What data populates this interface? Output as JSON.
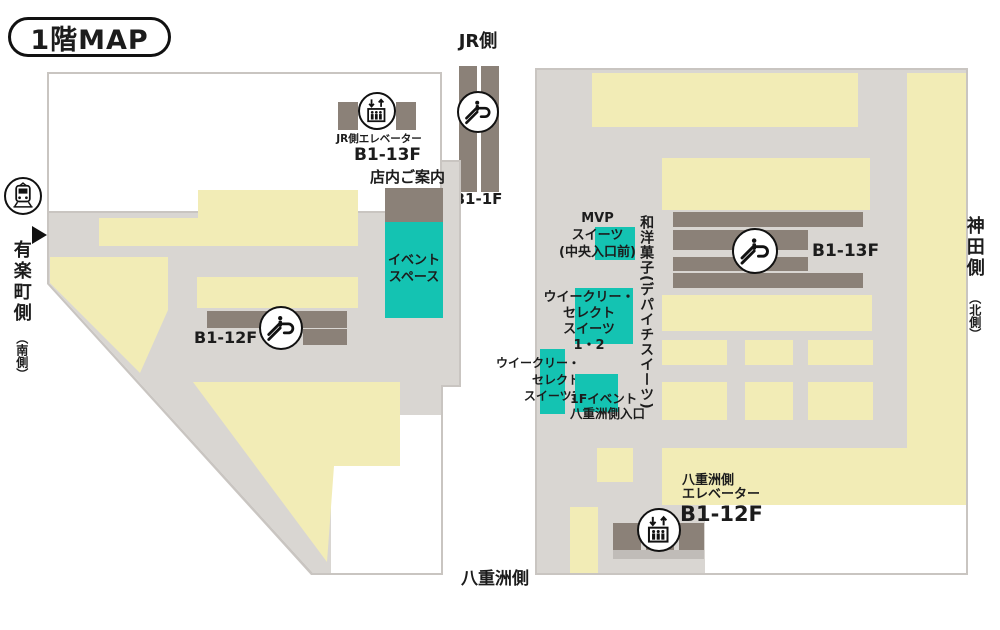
{
  "title": "1階MAP",
  "colors": {
    "floor": "#d9d6d2",
    "floor_border": "#c9c5c1",
    "sales": "#f2ecb6",
    "fixture": "#8b8178",
    "teal": "#14c3b2",
    "ink": "#1c1c1c"
  },
  "labels": {
    "jr_side": "JR側",
    "jr_escalator_floors": "B1-1F",
    "yurakucho": "有楽町側",
    "yurakucho_sub": "（南側）",
    "kanda": "神田側",
    "kanda_sub": "（北側）",
    "yaesu_bottom": "八重洲側"
  },
  "left_building": {
    "jr_elevator_label": "JR側エレベーター",
    "jr_elevator_floors": "B1-13F",
    "info_label": "店内ご案内",
    "event_space": [
      "イベント",
      "スペース"
    ],
    "escalator_floors": "B1-12F"
  },
  "right_building": {
    "escalator_floors": "B1-13F",
    "mvp_sweets": [
      "MVP",
      "スイーツ",
      "(中央入口前)"
    ],
    "wagashi_vertical": "和洋菓子(デパイチスイーツ)",
    "weekly_select_12": [
      "ウイークリー・",
      "セレクト",
      "スイーツ",
      "1・2"
    ],
    "weekly_select_3": [
      "ウイークリー・",
      "セレクト",
      "スイーツ3"
    ],
    "f1_event_entrance": [
      "1Fイベント",
      "八重洲側入口"
    ],
    "yaesu_elevator_label": [
      "八重洲側",
      "エレベーター"
    ],
    "yaesu_elevator_floors": "B1-12F"
  }
}
